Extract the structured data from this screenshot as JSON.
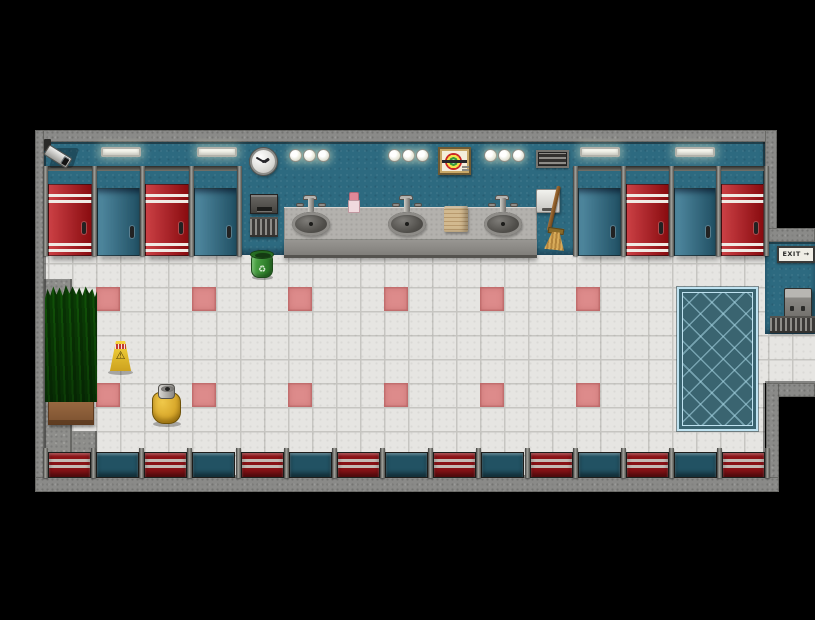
{
  "window": {
    "width": 815,
    "height": 620,
    "background": "#000000"
  },
  "scene": {
    "name": "public restroom interior",
    "style": "top-down tile map"
  },
  "palette": {
    "wall_gray": "#8a8a88",
    "wall_teal": "#2d6a80",
    "floor_tile": "#e6e5e2",
    "grout": "#c6c5c1",
    "accent_tile": "#dd8b8b",
    "door_red": "#be1016",
    "door_blue": "#2f738f",
    "bottom_door_red": "#8a1216",
    "bottom_door_blue": "#225263",
    "mat_base": "#3a6470",
    "mat_border": "#bfe2f0"
  },
  "stalls": {
    "top_left": [
      "red",
      "blue",
      "red",
      "blue"
    ],
    "top_right": [
      "blue",
      "red",
      "blue",
      "red"
    ],
    "bottom": [
      "red",
      "blue",
      "red",
      "blue",
      "red",
      "blue",
      "red",
      "blue",
      "red",
      "blue",
      "red",
      "blue",
      "red",
      "blue",
      "red"
    ]
  },
  "floor": {
    "accent_rows": [
      287,
      383
    ],
    "accent_cols": [
      96,
      192,
      288,
      384,
      480,
      576
    ]
  },
  "objects": {
    "clock": {
      "time": "1:50"
    },
    "exit_sign": {
      "label": "EXIT →"
    },
    "wet_floor_sign": {
      "symbol": "⚠"
    },
    "trash_can": {
      "symbol": "♻"
    }
  }
}
